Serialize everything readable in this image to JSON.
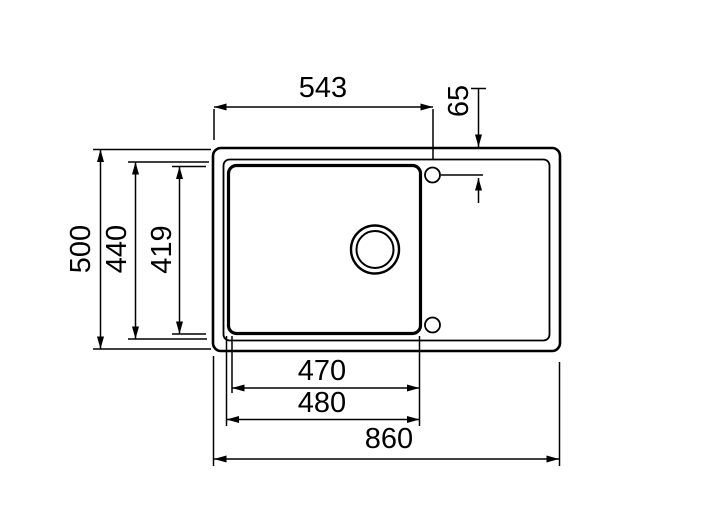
{
  "drawing": {
    "type": "sink-top-view-technical-drawing",
    "units": "mm",
    "colors": {
      "line": "#000000",
      "background": "#ffffff"
    },
    "dimensions": {
      "top_width": "543",
      "faucet_hole_offset": "65",
      "overall_depth": "500",
      "rim_depth": "440",
      "bowl_inner_depth": "419",
      "bowl_inner_width": "470",
      "bowl_outer_width": "480",
      "overall_width": "860"
    }
  }
}
